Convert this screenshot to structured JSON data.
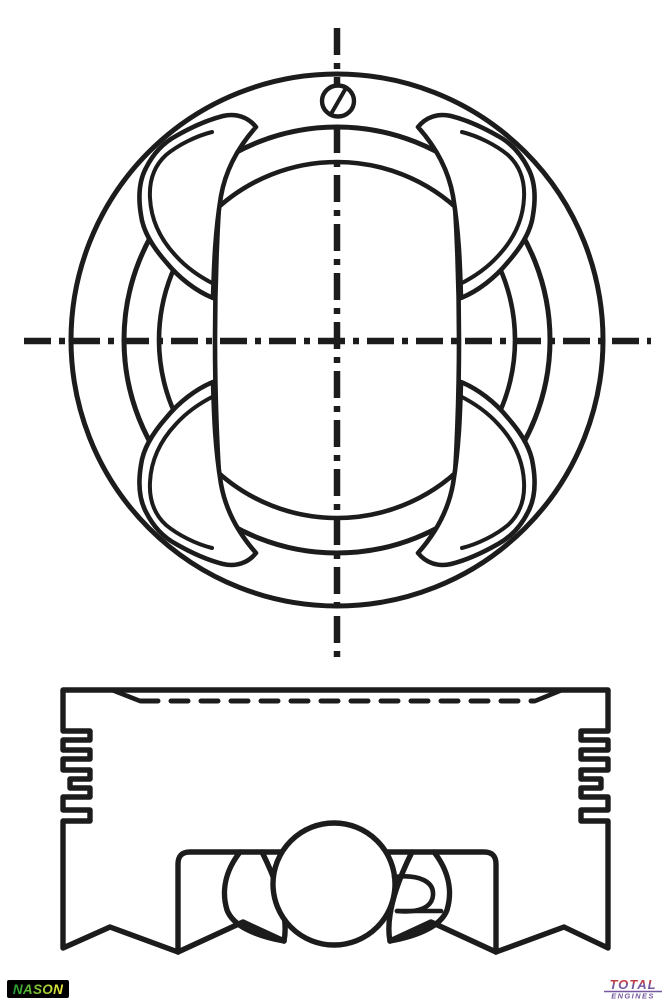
{
  "figure": {
    "type": "technical line drawing",
    "subject": "engine piston",
    "views": [
      "piston crown top view with four valve pockets",
      "piston side view with ring grooves, skirt and wrist pin"
    ],
    "line_color": "#1c1c1c",
    "background": "#ffffff"
  },
  "branding": {
    "nason": {
      "label": "NASON",
      "bg": "#000000",
      "gradient_start": "#1e9e35",
      "gradient_mid": "#8fc832",
      "gradient_end": "#f5ef3d"
    },
    "total": {
      "label": "TOTAL",
      "sublabel": "ENGINES",
      "primary": "#75589f",
      "accent": "#c03d46"
    }
  }
}
